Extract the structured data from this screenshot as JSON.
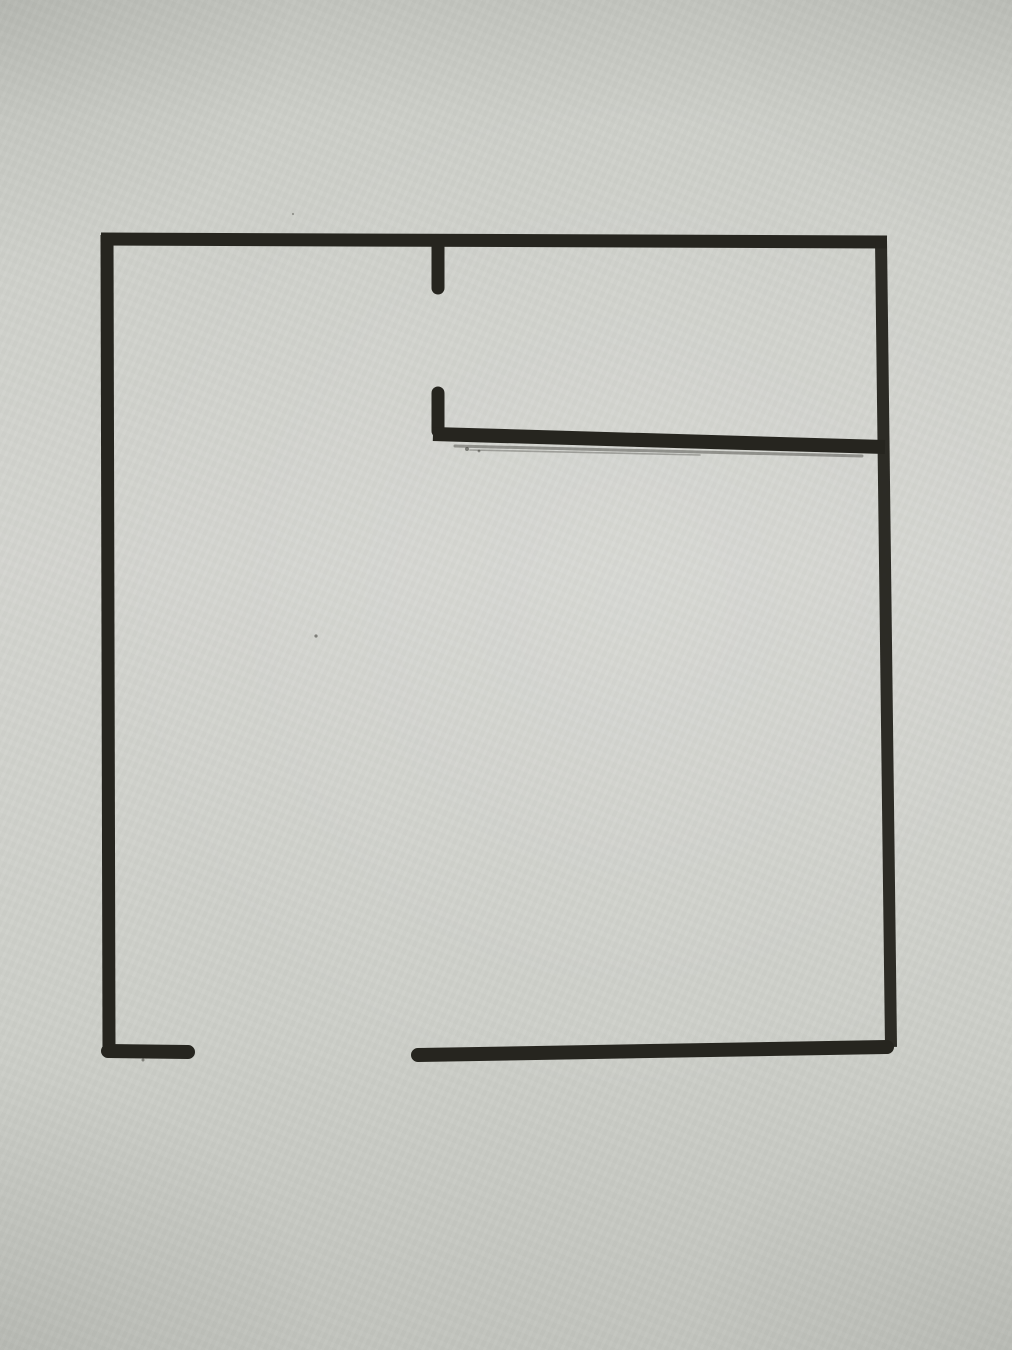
{
  "scene": {
    "type": "hand-drawn-sketch",
    "description": "Photograph of a floor-plan style outline drawn in thick black marker on gray paper: a large square room, a doorway stub on the top wall, an interior partition wall with an end stub attached to the right wall, and a door opening in the bottom wall"
  },
  "colors": {
    "paper": "#cdcfc9",
    "paper_light": "#d4d5d0",
    "paper_dark": "#c2c4be",
    "ink": "#26251f"
  },
  "sketch": {
    "canvas": {
      "width": 1012,
      "height": 1350
    },
    "strokes": [
      {
        "name": "outline-top-wall",
        "x1": 101,
        "y1": 239,
        "x2": 887,
        "y2": 242,
        "width": 13,
        "cap": "butt",
        "opacity": 1
      },
      {
        "name": "outline-left-wall",
        "x1": 107,
        "y1": 235,
        "x2": 109,
        "y2": 1050,
        "width": 13,
        "cap": "butt",
        "opacity": 1
      },
      {
        "name": "outline-right-wall",
        "x1": 881,
        "y1": 240,
        "x2": 891,
        "y2": 1047,
        "width": 12,
        "cap": "butt",
        "opacity": 0.96
      },
      {
        "name": "top-doorway-stub",
        "x1": 438,
        "y1": 245,
        "x2": 438,
        "y2": 288,
        "width": 13,
        "cap": "round",
        "opacity": 1
      },
      {
        "name": "partition-end-stub",
        "x1": 438,
        "y1": 393,
        "x2": 438,
        "y2": 431,
        "width": 13,
        "cap": "round",
        "opacity": 1
      },
      {
        "name": "partition-wall-line",
        "x1": 433,
        "y1": 434,
        "x2": 885,
        "y2": 447,
        "width": 14,
        "cap": "butt",
        "opacity": 1
      },
      {
        "name": "partition-dry-marker-edge",
        "x1": 455,
        "y1": 446,
        "x2": 862,
        "y2": 456,
        "width": 3,
        "cap": "round",
        "opacity": 0.38
      },
      {
        "name": "partition-dry-marker-edge-2",
        "x1": 470,
        "y1": 450,
        "x2": 700,
        "y2": 455,
        "width": 1.6,
        "cap": "round",
        "opacity": 0.3
      },
      {
        "name": "bottom-left-wall-segment",
        "x1": 108,
        "y1": 1051,
        "x2": 188,
        "y2": 1052,
        "width": 14,
        "cap": "round",
        "opacity": 1
      },
      {
        "name": "bottom-right-wall-segment",
        "x1": 418,
        "y1": 1055,
        "x2": 887,
        "y2": 1047,
        "width": 14,
        "cap": "round",
        "opacity": 1
      }
    ],
    "specks": [
      {
        "name": "paper-speck",
        "x": 316,
        "y": 636,
        "r": 1.6,
        "opacity": 0.5
      },
      {
        "name": "paper-speck",
        "x": 293,
        "y": 214,
        "r": 1.1,
        "opacity": 0.35
      },
      {
        "name": "ink-dot",
        "x": 467,
        "y": 449,
        "r": 2.0,
        "opacity": 0.5
      },
      {
        "name": "ink-dot",
        "x": 479,
        "y": 451,
        "r": 1.4,
        "opacity": 0.45
      },
      {
        "name": "ink-dot",
        "x": 143,
        "y": 1060,
        "r": 1.5,
        "opacity": 0.45
      }
    ]
  }
}
